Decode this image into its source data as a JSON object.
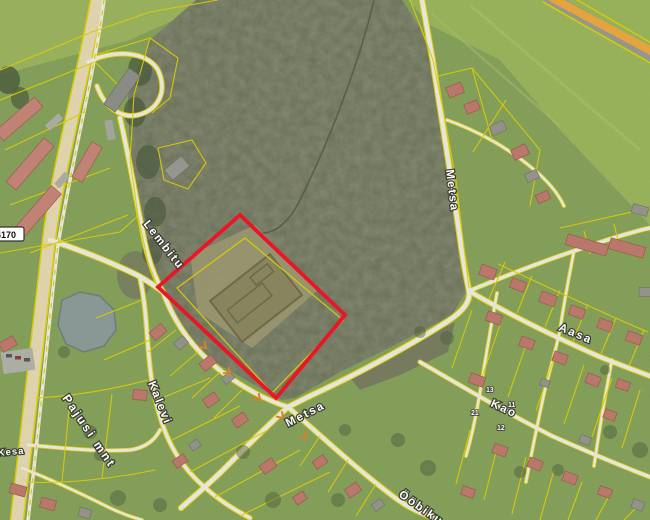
{
  "map": {
    "street_labels": {
      "pajusi": {
        "text": "Pajusi mnt"
      },
      "lembitu": {
        "text": "Lembitu"
      },
      "kalevi": {
        "text": "Kalevi"
      },
      "metsa_north": {
        "text": "Metsa"
      },
      "metsa_south": {
        "text": "Metsa"
      },
      "aasa": {
        "text": "Aasa"
      },
      "kao": {
        "text": "Kao"
      },
      "oobiku": {
        "text": "Ööbiku"
      },
      "kesa": {
        "text": "Kesa"
      }
    },
    "road_number_badge": {
      "text": "4170"
    },
    "house_numbers": [
      {
        "text": "21"
      },
      {
        "text": "13"
      },
      {
        "text": "11"
      },
      {
        "text": "12"
      }
    ],
    "colors": {
      "selection_red": "#ea1526",
      "parcel_yellow": "#e3d400",
      "highway_orange": "#f0a93e",
      "road_white": "#f2f0e8",
      "main_road_beige": "#e9dcb4",
      "field_green": "#9cb75c",
      "forest_green": "#6b7057",
      "pond_gray": "#8d9c9b",
      "roof_red": "#c1796d",
      "roof_gray": "#97968e"
    }
  }
}
